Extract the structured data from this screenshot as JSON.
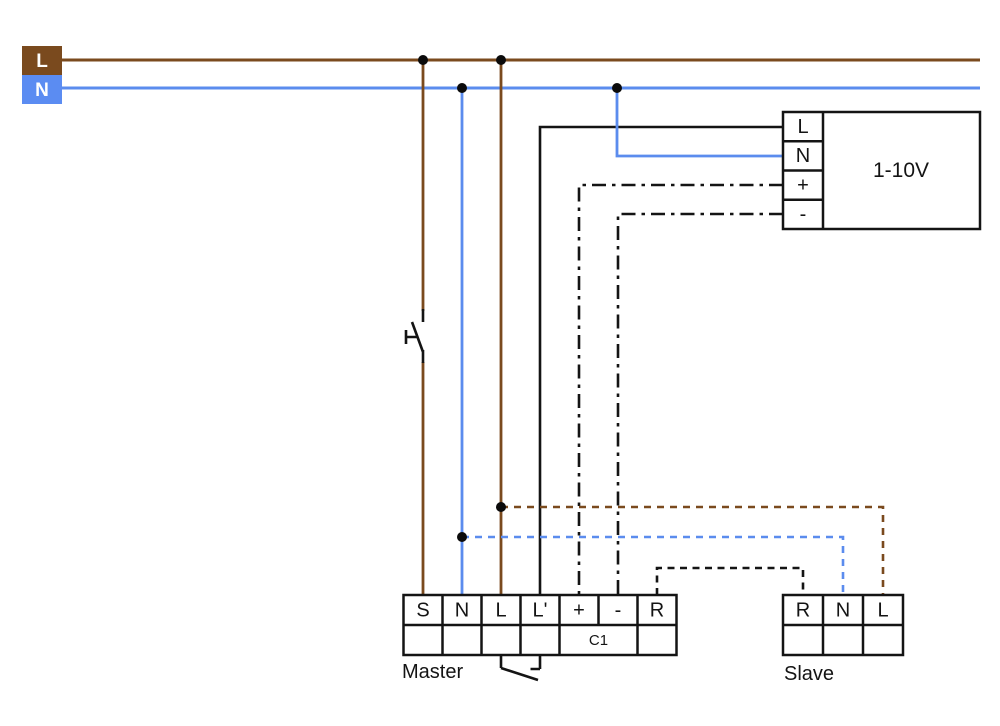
{
  "supply": {
    "l_label": "L",
    "n_label": "N"
  },
  "device": {
    "title": "1-10V",
    "terminals": [
      "L",
      "N",
      "+",
      "-"
    ]
  },
  "master": {
    "label": "Master",
    "terminals": [
      "S",
      "N",
      "L",
      "L'",
      "+",
      "-",
      "R"
    ],
    "channel": "C1"
  },
  "slave": {
    "label": "Slave",
    "terminals": [
      "R",
      "N",
      "L"
    ]
  },
  "colors": {
    "brown": "#7a4a1e",
    "blue": "#5b8cee",
    "blue_box": "#5b8cf2",
    "ink": "#141414",
    "label_on_color": "#ffffff"
  }
}
